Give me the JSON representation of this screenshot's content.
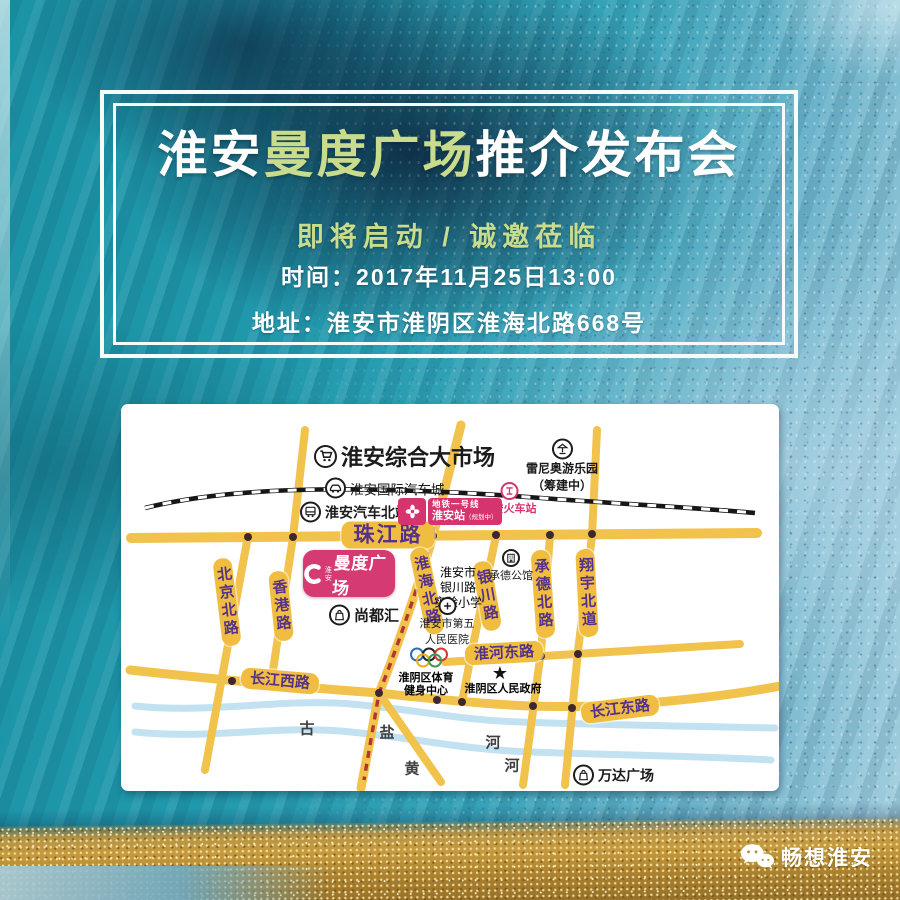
{
  "header": {
    "title_prefix": "淮安",
    "title_highlight": "曼度广场",
    "title_suffix": "推介发布会",
    "subtitle": "即将启动 / 诚邀莅临",
    "time_line": "时间：2017年11月25日13:00",
    "address_line": "地址：淮安市淮阴区淮海北路668号"
  },
  "map": {
    "roads": {
      "zhujiang": "珠江路",
      "beijing": "北京北路",
      "hongkong": "香港路",
      "huaihai": "淮海北路",
      "yinchuan": "银川路",
      "chengde": "承德北路",
      "xiangyu": "翔宇北道",
      "huaihe": "淮河东路",
      "changjiang_west": "长江西路",
      "changjiang_east": "长江东路"
    },
    "pois": {
      "market": "淮安综合大市场",
      "auto_city": "淮安国际汽车城",
      "bus_station": "淮安汽车北站",
      "metro_line": "地铁一号线",
      "metro_station": "淮安站",
      "metro_note": "（规划中）",
      "railway_station": "淮安火车站",
      "amusement_1": "雷尼奥游乐园",
      "amusement_2": "（筹建中）",
      "brand_city": "淮安",
      "brand_name": "曼度广场",
      "shangduhui": "尚都汇",
      "school_1": "淮安市",
      "school_2": "银川路",
      "school_3": "实验小学",
      "chengde_mansion": "承德公馆",
      "hospital_1": "淮安市第五",
      "hospital_2": "人民医院",
      "sports_1": "淮阴区体育",
      "sports_2": "健身中心",
      "government": "淮阴区人民政府",
      "wanda": "万达广场"
    },
    "river_chars": {
      "gu": "古",
      "yan": "盐",
      "huang": "黄",
      "he1": "河",
      "he2": "河"
    },
    "icons": {
      "star": "★"
    },
    "colors": {
      "road_yellow": "#f1c24c",
      "road_label_purple": "#54328a",
      "accent_pink": "#d6346f",
      "river_blue": "#c2e2f2",
      "metro_line_red": "#b23434",
      "railway_black": "#17171a",
      "title_highlight_green": "#c9db8c",
      "gold": "#c59a3e"
    }
  },
  "footer": {
    "brand": "畅想淮安"
  }
}
